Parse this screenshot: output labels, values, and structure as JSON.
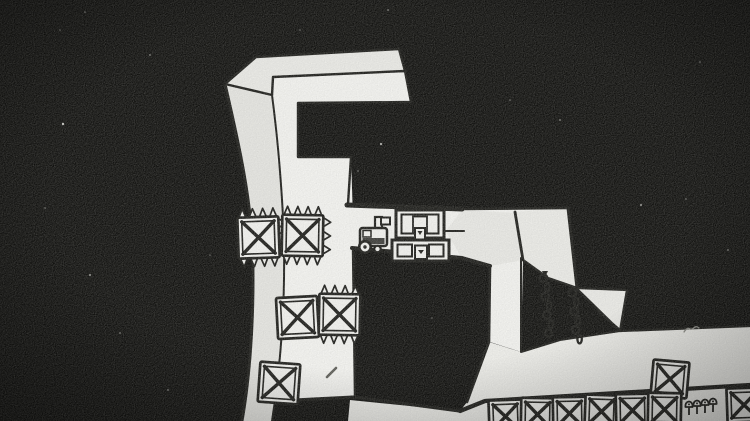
{
  "meta": {
    "type": "game-frame",
    "style": "hand-drawn monochrome platformer scene"
  },
  "palette": {
    "background": "#0f0f0d",
    "ink": "#1c1c19",
    "surface": "#f1f1ee",
    "surface_dim": "#e7e7e3",
    "pencil_gray": "#8c8c86"
  },
  "sprites": {
    "character": {
      "kind": "wheeled-robot",
      "x": 356,
      "y": 214
    },
    "dispenser": {
      "kind": "crate-dispenser",
      "x": 392,
      "y": 208
    },
    "crates": [
      {
        "id": "spiked-crate-1",
        "x": 238,
        "y": 217,
        "size": 41,
        "rot": -2,
        "spikes": [
          "top",
          "bottom",
          "right"
        ]
      },
      {
        "id": "spiked-crate-2",
        "x": 282,
        "y": 215,
        "size": 41,
        "rot": 1,
        "spikes": [
          "top",
          "bottom",
          "right"
        ]
      },
      {
        "id": "crate-3",
        "x": 277,
        "y": 297,
        "size": 41,
        "rot": -3,
        "spikes": []
      },
      {
        "id": "spiked-crate-4",
        "x": 319,
        "y": 294,
        "size": 41,
        "rot": 1,
        "spikes": [
          "top",
          "bottom"
        ]
      },
      {
        "id": "crate-5",
        "x": 259,
        "y": 363,
        "size": 40,
        "rot": 4,
        "spikes": []
      },
      {
        "id": "stacked-crate",
        "x": 652,
        "y": 361,
        "size": 36,
        "rot": 5,
        "spikes": []
      },
      {
        "id": "row-crate-1",
        "x": 489,
        "y": 400,
        "size": 33,
        "rot": -2,
        "spikes": []
      },
      {
        "id": "row-crate-2",
        "x": 521,
        "y": 398,
        "size": 33,
        "rot": 1,
        "spikes": []
      },
      {
        "id": "row-crate-3",
        "x": 553,
        "y": 397,
        "size": 33,
        "rot": -1,
        "spikes": []
      },
      {
        "id": "row-crate-4",
        "x": 585,
        "y": 395,
        "size": 33,
        "rot": 2,
        "spikes": []
      },
      {
        "id": "row-crate-5",
        "x": 616,
        "y": 394,
        "size": 33,
        "rot": -1,
        "spikes": []
      },
      {
        "id": "row-crate-6",
        "x": 648,
        "y": 393,
        "size": 33,
        "rot": 1,
        "spikes": []
      },
      {
        "id": "row-crate-7",
        "x": 727,
        "y": 388,
        "size": 34,
        "rot": -2,
        "spikes": []
      }
    ],
    "chains": [
      {
        "id": "chain-1",
        "x": 545,
        "y": 274,
        "links": 7,
        "drift": 5
      },
      {
        "id": "chain-2",
        "x": 574,
        "y": 289,
        "links": 6,
        "drift": 4
      }
    ],
    "mushrooms": [
      {
        "x": 689,
        "y": 402
      },
      {
        "x": 697,
        "y": 401
      },
      {
        "x": 705,
        "y": 400
      },
      {
        "x": 713,
        "y": 399
      }
    ],
    "pen_marks": [
      {
        "id": "tick",
        "x1": 327,
        "y1": 377,
        "x2": 336,
        "y2": 368
      },
      {
        "id": "scribble",
        "path": "M 684,332 q 3,-5 6,-3 q 2,1 5,-2 q 2,-1 4,1"
      }
    ],
    "speckles": [
      [
        63,
        124,
        1.2,
        0.8
      ],
      [
        90,
        275,
        1,
        0.6
      ],
      [
        120,
        333,
        0.9,
        0.5
      ],
      [
        45,
        208,
        0.8,
        0.5
      ],
      [
        150,
        55,
        0.9,
        0.5
      ],
      [
        381,
        144,
        1.1,
        0.7
      ],
      [
        358,
        171,
        0.8,
        0.5
      ],
      [
        641,
        205,
        1,
        0.6
      ],
      [
        686,
        199,
        0.8,
        0.5
      ],
      [
        560,
        120,
        0.9,
        0.5
      ],
      [
        700,
        62,
        0.8,
        0.5
      ],
      [
        168,
        390,
        0.9,
        0.5
      ],
      [
        60,
        30,
        0.8,
        0.4
      ],
      [
        728,
        250,
        0.9,
        0.5
      ],
      [
        432,
        318,
        0.8,
        0.4
      ],
      [
        210,
        255,
        0.8,
        0.4
      ],
      [
        510,
        100,
        0.8,
        0.45
      ],
      [
        300,
        30,
        0.8,
        0.4
      ],
      [
        85,
        12,
        0.8,
        0.5
      ],
      [
        388,
        10,
        0.9,
        0.5
      ]
    ]
  }
}
